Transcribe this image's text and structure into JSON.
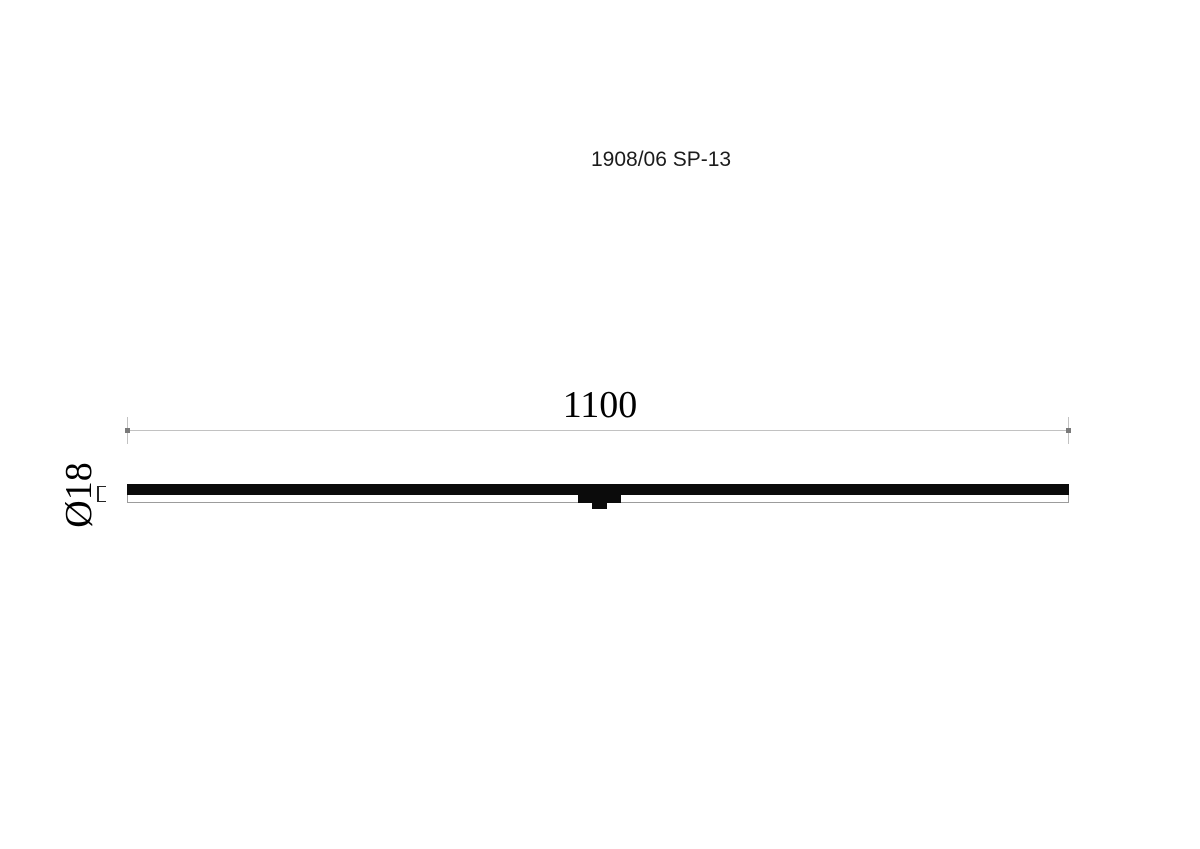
{
  "title": {
    "text": "1908/06 SP-13"
  },
  "dimensions": {
    "length": {
      "label": "1100"
    },
    "diameter": {
      "label": "Ø18"
    }
  },
  "colors": {
    "page-bg": "#ffffff",
    "body-black": "#0b0b0b",
    "line-gray": "#c2c2c2",
    "tick-gray": "#7a7a7a",
    "outline-gray": "#9c9c9c",
    "text-black": "#1c1c1c"
  }
}
